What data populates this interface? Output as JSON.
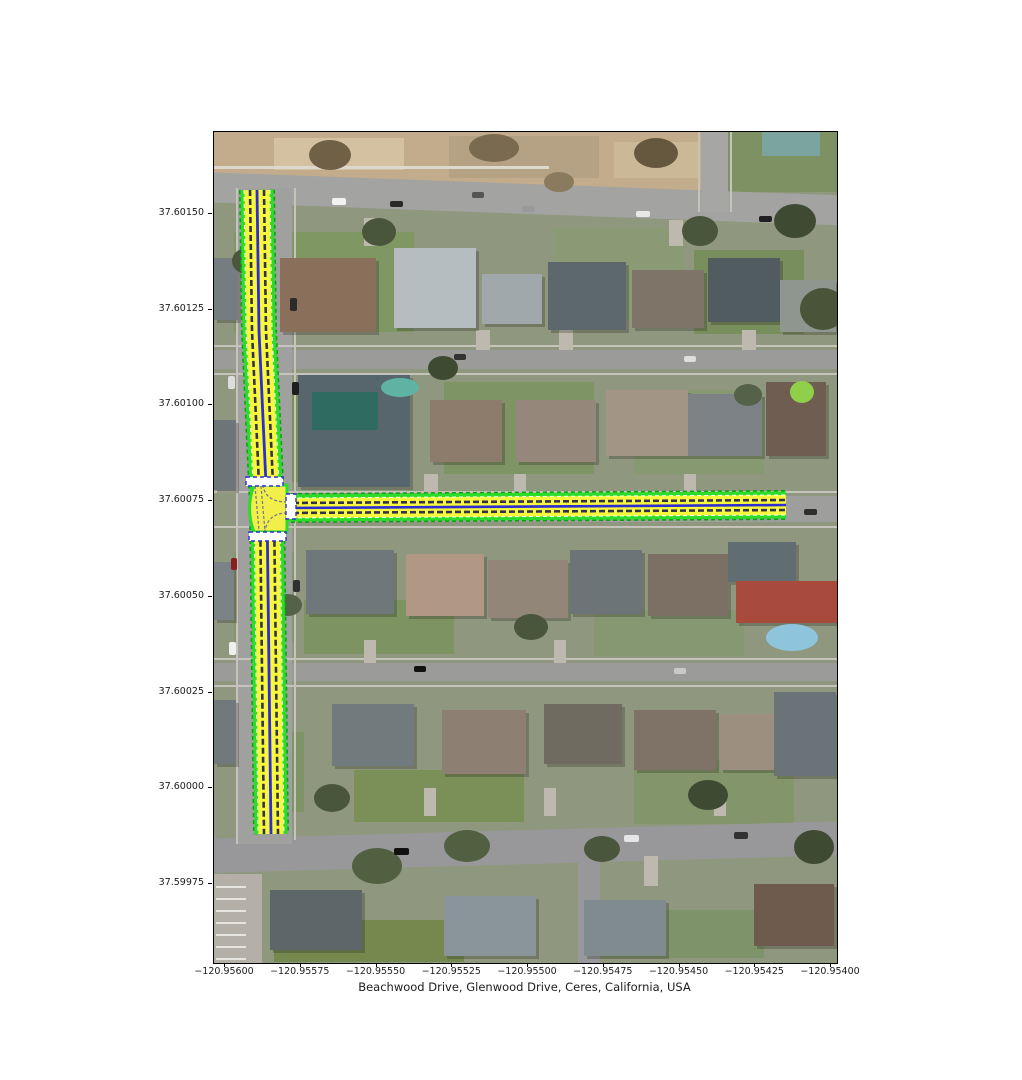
{
  "figure": {
    "xlabel": "Beachwood Drive, Glenwood Drive, Ceres, California, USA",
    "x_tick_labels": [
      "−120.95600",
      "−120.95575",
      "−120.95550",
      "−120.95525",
      "−120.95500",
      "−120.95475",
      "−120.95450",
      "−120.95425",
      "−120.95400"
    ],
    "y_tick_labels": [
      "37.60150",
      "37.60125",
      "37.60100",
      "37.60075",
      "37.60050",
      "37.60025",
      "37.60000",
      "37.59975"
    ]
  },
  "map": {
    "location": "Beachwood Drive, Glenwood Drive, Ceres, California, USA",
    "roads": [
      {
        "name": "Beachwood Drive",
        "orientation": "vertical"
      },
      {
        "name": "Glenwood Drive",
        "orientation": "horizontal"
      }
    ],
    "junction": {
      "type": "T-intersection",
      "crosswalks": 3
    },
    "overlay_colors": {
      "edge_green": "#2bdc2b",
      "edge_green_dark": "#119e11",
      "lane_yellow": "#f7f73b",
      "lane_line_white": "#ffffff",
      "lane_center_navy": "#32324e",
      "divider_blue": "#2d2dd2",
      "junction_fill": "#f2ef4a",
      "guide_line": "#70748e",
      "crosswalk_fill": "#ffffff",
      "crosswalk_border": "#2d2dd2"
    }
  }
}
